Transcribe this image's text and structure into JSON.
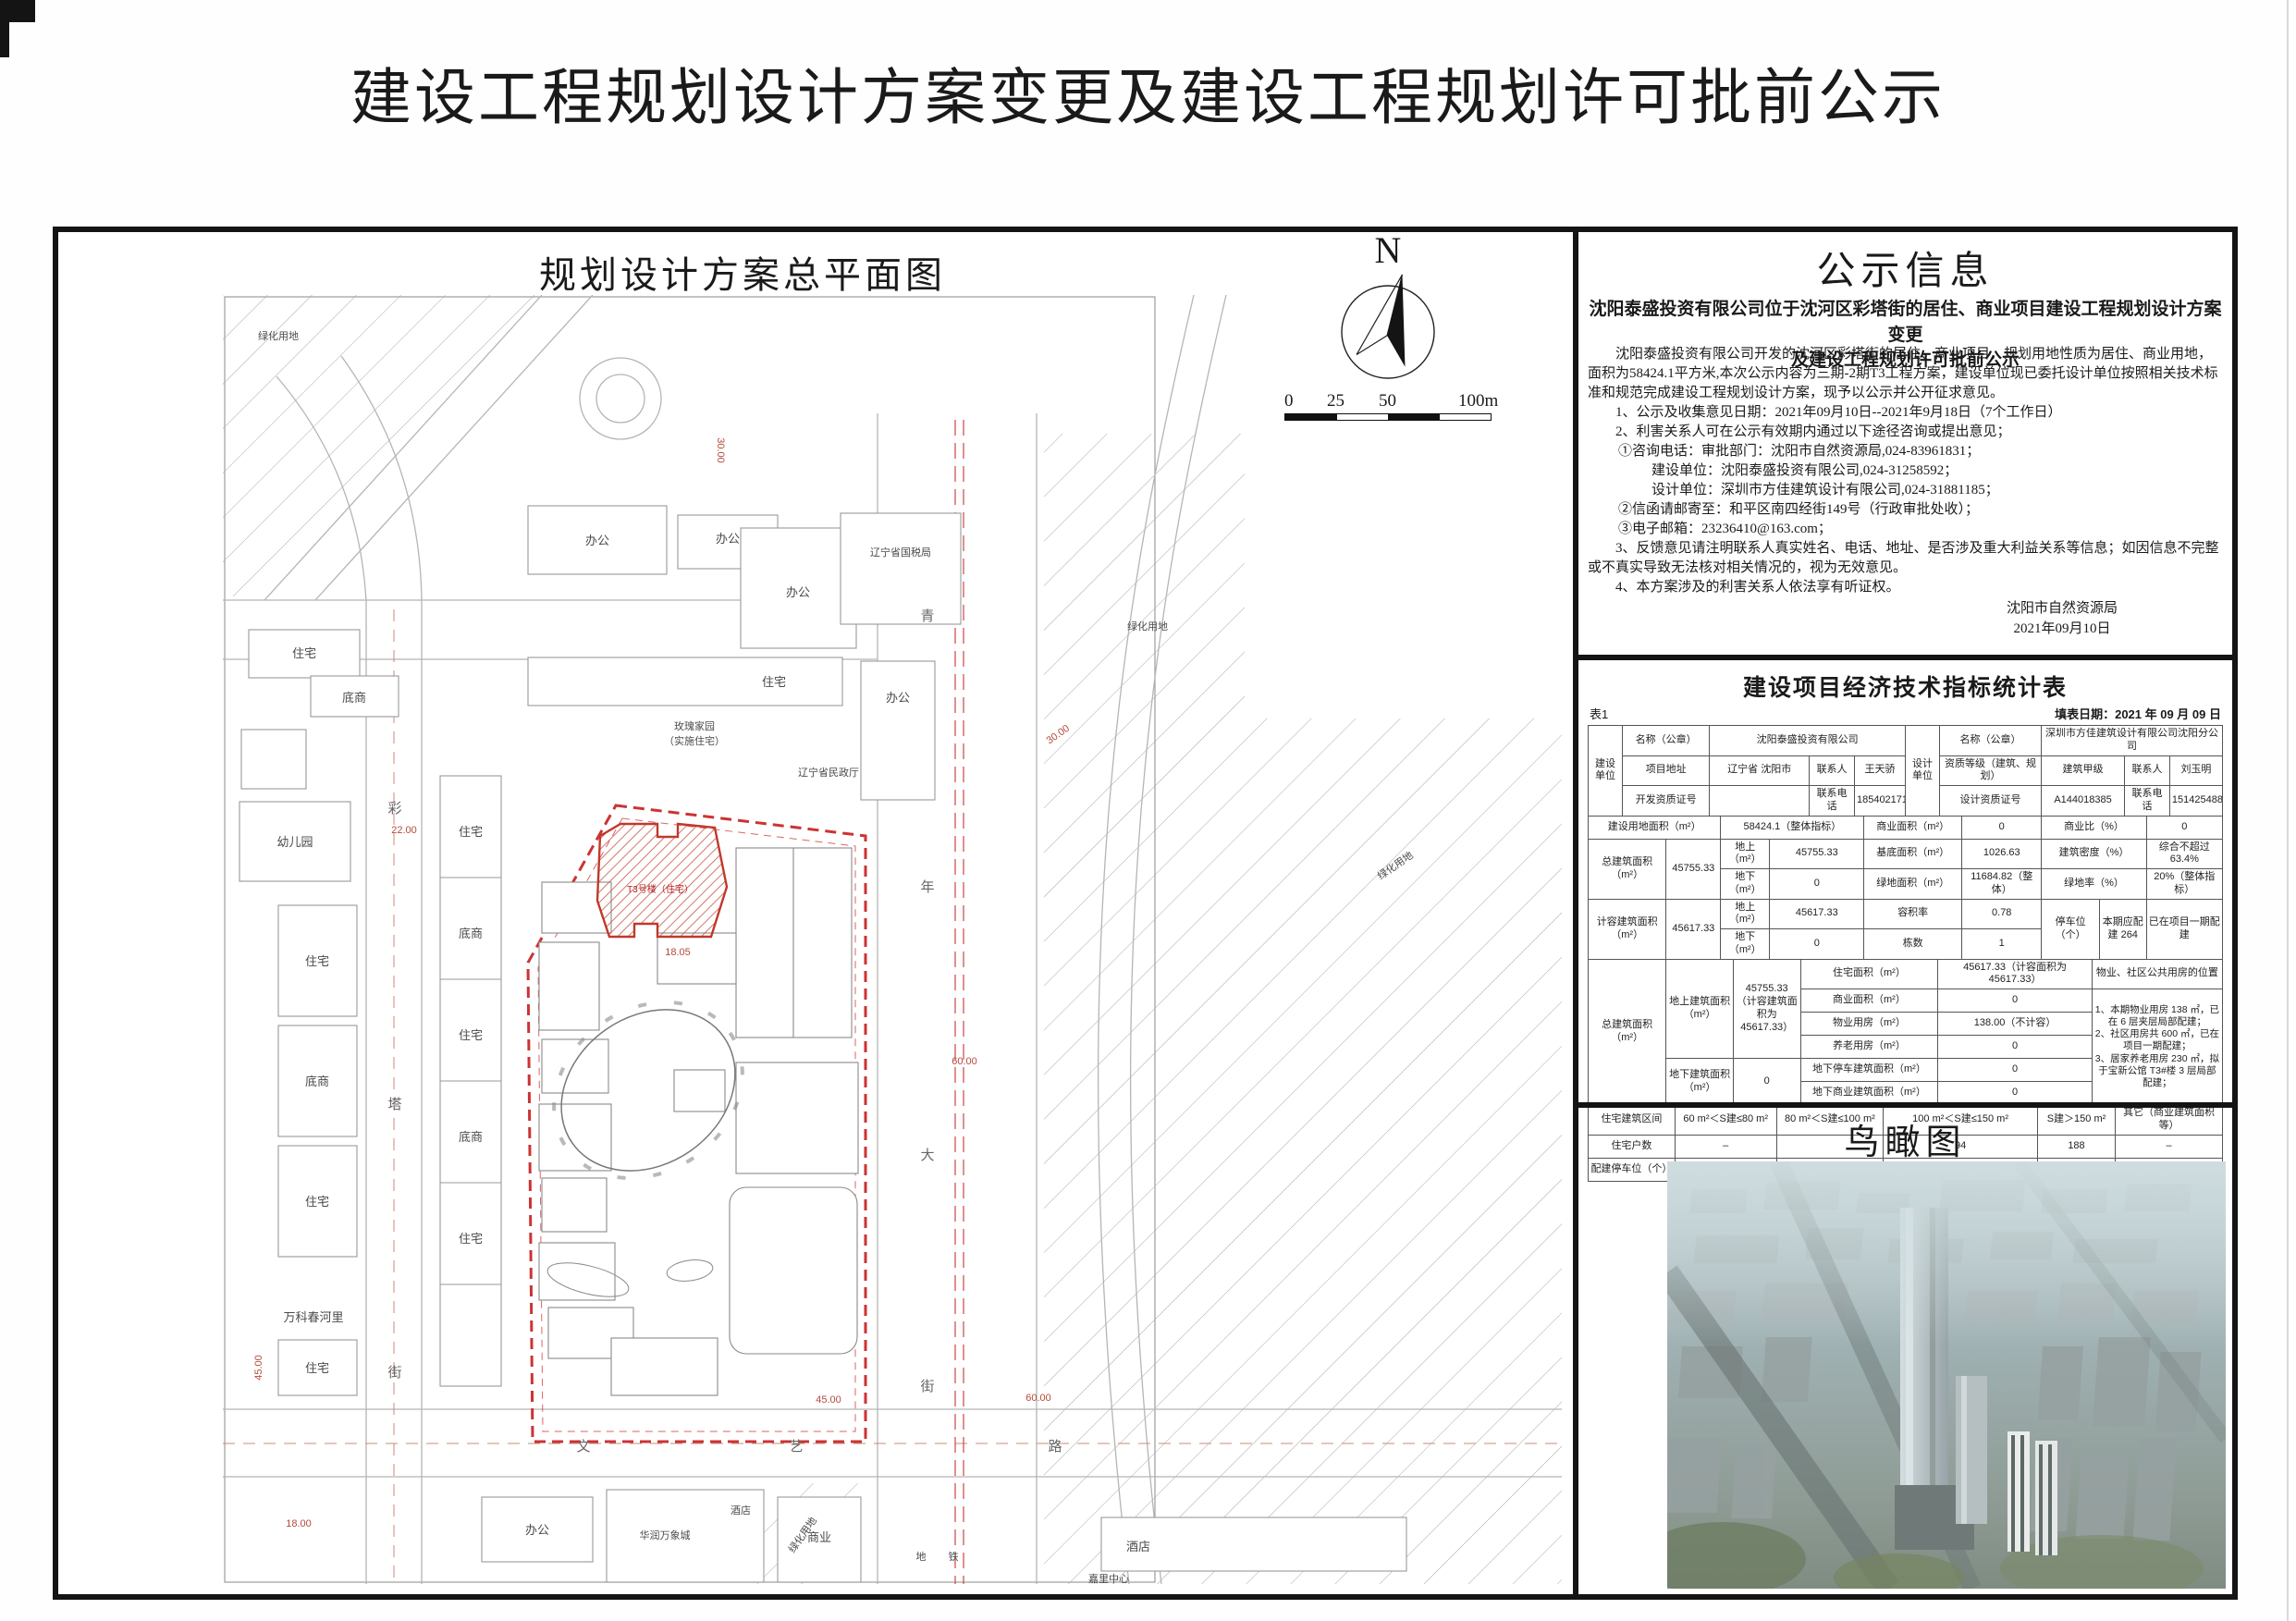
{
  "page": {
    "title": "建设工程规划设计方案变更及建设工程规划许可批前公示"
  },
  "plan": {
    "title": "规划设计方案总平面图",
    "north_letter": "N",
    "scale": {
      "t0": "0",
      "t25": "25",
      "t50": "50",
      "t100": "100m"
    },
    "labels": {
      "residential": "住宅",
      "shop": "底商",
      "office": "办公",
      "kindergarten": "幼儿园",
      "wanke": "万科春河里",
      "tax_bureau": "辽宁省国税局",
      "civil_affairs": "辽宁省民政厅",
      "rose1": "玫瑰家园",
      "rose2": "（实施住宅）",
      "hrmall": "华润万象城",
      "hotel": "酒店",
      "commerce": "商业",
      "green": "绿化用地",
      "jiali": "嘉里中心",
      "metro1": "地",
      "metro2": "铁",
      "t3": "T3号楼（住宅）"
    },
    "streets": {
      "cai": [
        "彩",
        "塔",
        "街"
      ],
      "qing": [
        "青",
        "年",
        "大",
        "街"
      ],
      "wenyi": [
        "文",
        "艺",
        "路"
      ]
    },
    "dims": {
      "d22": "22.00",
      "d18": "18.00",
      "d30": "30.00",
      "d45": "45.00",
      "d60": "60.00",
      "d1805": "18.05"
    }
  },
  "notice": {
    "title": "公示信息",
    "subtitle1": "沈阳泰盛投资有限公司位于沈河区彩塔街的居住、商业项目建设工程规划设计方案变更",
    "subtitle2": "及建设工程规划许可批前公示",
    "intro": "沈阳泰盛投资有限公司开发的沈河区彩塔街的居住、商业项目，规划用地性质为居住、商业用地，面积为58424.1平方米,本次公示内容为三期-2期T3工程方案，建设单位现已委托设计单位按照相关技术标准和规范完成建设工程规划设计方案，现予以公示并公开征求意见。",
    "item1": "1、公示及收集意见日期：2021年09月10日--2021年9月18日（7个工作日）",
    "item2": "2、利害关系人可在公示有效期内通过以下途径咨询或提出意见；",
    "item2_1": "①咨询电话：审批部门：沈阳市自然资源局,024-83961831；",
    "item2_1b": "建设单位：沈阳泰盛投资有限公司,024-31258592；",
    "item2_1c": "设计单位：深圳市方佳建筑设计有限公司,024-31881185；",
    "item2_2": "②信函请邮寄至：和平区南四经街149号（行政审批处收）；",
    "item2_3": "③电子邮箱：23236410@163.com；",
    "item3": "3、反馈意见请注明联系人真实姓名、电话、地址、是否涉及重大利益关系等信息；如因信息不完整或不真实导致无法核对相关情况的，视为无效意见。",
    "item4": "4、本方案涉及的利害关系人依法享有听证权。",
    "issuer": "沈阳市自然资源局",
    "issue_date": "2021年09月10日"
  },
  "table": {
    "title": "建设项目经济技术指标统计表",
    "tag": "表1",
    "fill_date": "填表日期：2021 年 09 月 09 日",
    "builder_label": "建设单位",
    "name_label": "名称（公章）",
    "builder_name": "沈阳泰盛投资有限公司",
    "addr_label": "项目地址",
    "addr": "辽宁省 沈阳市",
    "contact_label": "联系人",
    "builder_contact": "王天骄",
    "dev_cert_label": "开发资质证号",
    "dev_cert": "",
    "phone_label": "联系电话",
    "builder_phone": "18540217100",
    "designer_label": "设计单位",
    "designer_name": "深圳市方佳建筑设计有限公司沈阳分公司",
    "qual_label": "资质等级（建筑、规划）",
    "qual": "建筑甲级",
    "designer_contact": "刘玉明",
    "design_cert_label": "设计资质证号",
    "design_cert": "A144018385",
    "designer_phone": "15142548882",
    "land_area_label": "建设用地面积（m²）",
    "land_area": "58424.1（整体指标）",
    "comm_area_label": "商业面积（m²）",
    "comm_area": "0",
    "comm_ratio_label": "商业比（%）",
    "comm_ratio": "0",
    "total_area_label": "总建筑面积（m²）",
    "total_area": "45755.33",
    "above_label": "地上（m²）",
    "above_val": "45755.33",
    "base_label": "基底面积（m²）",
    "base_val": "1026.63",
    "density_label": "建筑密度（%）",
    "density_val": "综合不超过 63.4%",
    "below_label": "地下（m²）",
    "below_val": "0",
    "green_label": "绿地面积（m²）",
    "green_val": "11684.82（整体）",
    "green_rate_label": "绿地率（%）",
    "green_rate_val": "20%（整体指标）",
    "cap_area_label": "计容建筑面积（m²）",
    "cap_area": "45617.33",
    "cap_above": "45617.33",
    "far_label": "容积率",
    "far_val": "0.78",
    "parking_label": "停车位（个）",
    "parking_cur": "本期应配建 264",
    "parking_note": "已在项目一期配建",
    "cap_below": "0",
    "blocks_label": "栋数",
    "blocks_val": "1",
    "total2_label": "总建筑面积（m²）",
    "above_area_label": "地上建筑面积（m²）",
    "above_area_val": "45755.33（计容建筑面积为45617.33）",
    "resi_label": "住宅面积（m²）",
    "resi_val": "45617.33（计容面积为45617.33）",
    "pos_header": "物业、社区公共用房的位置",
    "comm2_label": "商业面积（m²）",
    "comm2_val": "0",
    "prop_label": "物业用房（m²）",
    "prop_val": "138.00（不计容）",
    "elder_label": "养老用房（m²）",
    "elder_val": "0",
    "below_area_label": "地下建筑面积（m²）",
    "below_area_val": "0",
    "u_park_label": "地下停车建筑面积（m²）",
    "u_park_val": "0",
    "u_comm_label": "地下商业建筑面积（m²）",
    "u_comm_val": "0",
    "pos_notes": "1、本期物业用房 138 ㎡，已在 6 层夹层局部配建；\n2、社区用房共 600 ㎡，已在项目一期配建；\n3、居家养老用房 230 ㎡，拟于宝新公馆 T3#楼 3 层局部配建；",
    "range_label": "住宅建筑区间",
    "range1": "60 m²＜S建≤80 m²",
    "range2": "80 m²＜S建≤100 m²",
    "range3": "100 m²＜S建≤150 m²",
    "range4": "S建＞150 m²",
    "range5": "其它（商业建筑面积等）",
    "units_label": "住宅户数",
    "units1": "–",
    "units2": "",
    "units3": "94",
    "units4": "188",
    "units5": "–",
    "park_label": "配建停车位（个）",
    "park1": "–",
    "park2": "",
    "park3": "76",
    "park4": "188",
    "park5": "–"
  },
  "birdview": {
    "title": "鸟瞰图"
  }
}
